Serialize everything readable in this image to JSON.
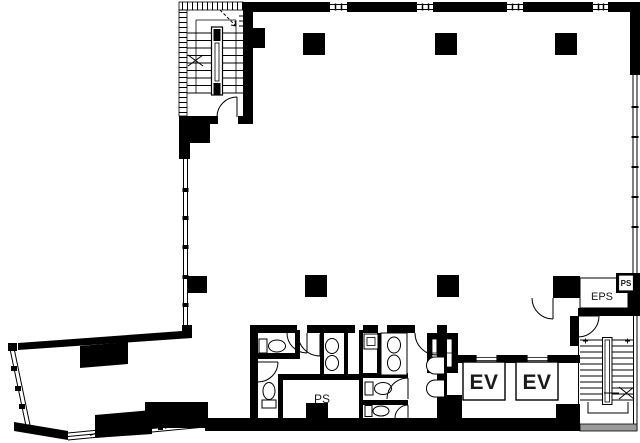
{
  "meta": {
    "document_type": "architectural floor plan",
    "background_color": "#ffffff",
    "wall_color": "#000000",
    "halftone_color": "#9a9a9a"
  },
  "labels": {
    "elevator_left": "EV",
    "elevator_right": "EV",
    "pipe_space": "PS",
    "eps_shaft": "EPS",
    "pipe_space_corner": "PS"
  }
}
